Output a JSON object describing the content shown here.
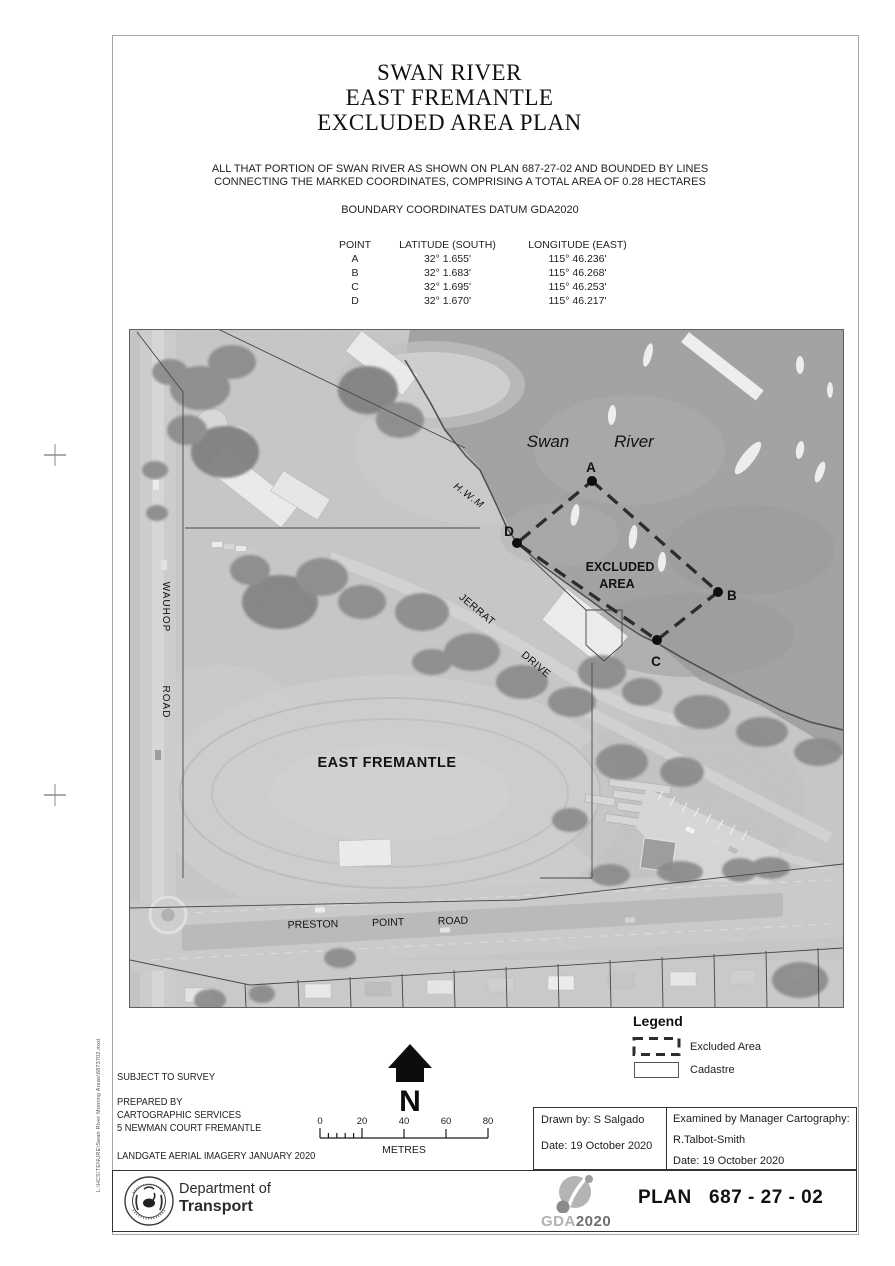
{
  "title": {
    "line1": "SWAN RIVER",
    "line2": "EAST FREMANTLE",
    "line3": "EXCLUDED AREA PLAN"
  },
  "description": {
    "line1": "ALL THAT PORTION OF SWAN RIVER AS SHOWN ON PLAN 687-27-02 AND BOUNDED BY LINES",
    "line2": "CONNECTING THE MARKED COORDINATES, COMPRISING A TOTAL AREA OF 0.28 HECTARES"
  },
  "datum_note": "BOUNDARY COORDINATES DATUM GDA2020",
  "coords": {
    "headers": {
      "point": "POINT",
      "lat": "LATITUDE (SOUTH)",
      "lon": "LONGITUDE (EAST)"
    },
    "rows": [
      {
        "point": "A",
        "lat": "32° 1.655'",
        "lon": "115° 46.236'"
      },
      {
        "point": "B",
        "lat": "32° 1.683'",
        "lon": "115° 46.268'"
      },
      {
        "point": "C",
        "lat": "32° 1.695'",
        "lon": "115° 46.253'"
      },
      {
        "point": "D",
        "lat": "32° 1.670'",
        "lon": "115° 46.217'"
      }
    ]
  },
  "map": {
    "labels": {
      "swan": "Swan",
      "river": "River",
      "excluded_line1": "EXCLUDED",
      "excluded_line2": "AREA",
      "suburb": "EAST FREMANTLE",
      "hwm": "H.W.M",
      "wauhop": {
        "w1": "WAUHOP",
        "w2": "ROAD"
      },
      "jerrat": {
        "w1": "JERRAT",
        "w2": "DRIVE"
      },
      "preston": "PRESTON  POINT  ROAD"
    },
    "points": [
      {
        "label": "A"
      },
      {
        "label": "B"
      },
      {
        "label": "C"
      },
      {
        "label": "D"
      }
    ]
  },
  "legend": {
    "title": "Legend",
    "items": [
      {
        "label": "Excluded Area"
      },
      {
        "label": "Cadastre"
      }
    ]
  },
  "notes": {
    "line1": "SUBJECT TO SURVEY",
    "line2": "PREPARED BY",
    "line3": "CARTOGRAPHIC SERVICES",
    "line4": "5 NEWMAN COURT FREMANTLE",
    "line5": "LANDGATE AERIAL IMAGERY JANUARY 2020"
  },
  "north": {
    "label": "N"
  },
  "scale": {
    "ticks": [
      "0",
      "20",
      "40",
      "60",
      "80"
    ],
    "unit": "METRES"
  },
  "approval": {
    "drawn_by": "Drawn by: S Salgado",
    "drawn_date": "Date: 19 October 2020",
    "examined_title": "Examined by Manager Cartography:",
    "examiner": "R.Talbot-Smith",
    "examined_date": "Date: 19 October 2020"
  },
  "footer": {
    "dept_line1": "Department of",
    "dept_line2": "Transport",
    "gda_part1": "GDA",
    "gda_part2": "2020",
    "plan_number": "PLAN   687 - 27 - 02"
  },
  "file_path": "L:\\HCS\\TENURE\\Swan River Mooring Areas\\6873702.mxd"
}
